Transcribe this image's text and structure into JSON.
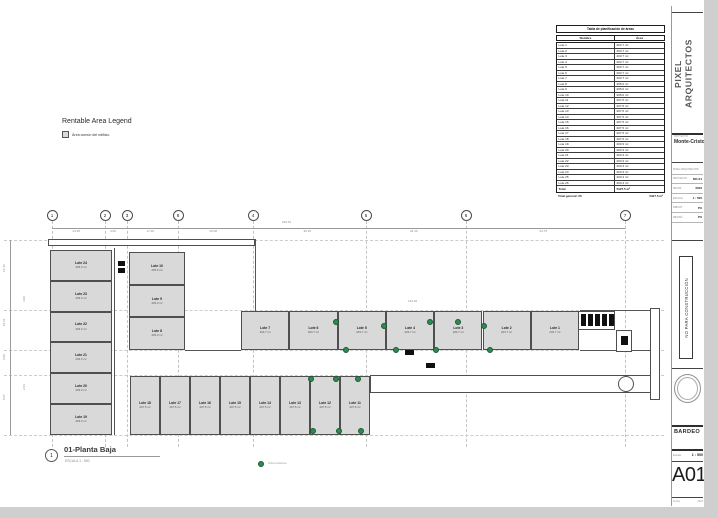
{
  "legend": {
    "title": "Rentable Area Legend",
    "item": "Área común del edificio",
    "swatch_color": "#d9d9d9"
  },
  "schedule": {
    "title": "Tabla de planificación de áreas",
    "columns": [
      "Nombre",
      "Área"
    ],
    "rows": [
      [
        "Lote 1",
        "203.7 m²"
      ],
      [
        "Lote 2",
        "203.7 m²"
      ],
      [
        "Lote 3",
        "203.7 m²"
      ],
      [
        "Lote 4",
        "203.7 m²"
      ],
      [
        "Lote 5",
        "203.7 m²"
      ],
      [
        "Lote 6",
        "203.7 m²"
      ],
      [
        "Lote 7",
        "203.7 m²"
      ],
      [
        "Lote 8",
        "205.0 m²"
      ],
      [
        "Lote 9",
        "205.0 m²"
      ],
      [
        "Lote 10",
        "205.0 m²"
      ],
      [
        "Lote 11",
        "207.5 m²"
      ],
      [
        "Lote 12",
        "207.5 m²"
      ],
      [
        "Lote 13",
        "207.5 m²"
      ],
      [
        "Lote 14",
        "207.5 m²"
      ],
      [
        "Lote 15",
        "207.5 m²"
      ],
      [
        "Lote 16",
        "207.5 m²"
      ],
      [
        "Lote 17",
        "207.5 m²"
      ],
      [
        "Lote 18",
        "207.5 m²"
      ],
      [
        "Lote 19",
        "203.3 m²"
      ],
      [
        "Lote 20",
        "203.3 m²"
      ],
      [
        "Lote 21",
        "203.3 m²"
      ],
      [
        "Lote 22",
        "203.3 m²"
      ],
      [
        "Lote 23",
        "203.3 m²"
      ],
      [
        "Lote 24",
        "203.3 m²"
      ],
      [
        "Lote 25",
        "203.4 m²"
      ],
      [
        "Lote 26",
        "203.4 m²"
      ]
    ],
    "total": [
      "Total",
      "5327.5 m²"
    ],
    "grand_total_label": "Total general: 26",
    "grand_total_value": "5327.5 m²"
  },
  "grid": {
    "bubbles": [
      {
        "label": "1",
        "x": 52
      },
      {
        "label": "2",
        "x": 105
      },
      {
        "label": "3",
        "x": 127
      },
      {
        "label": "8",
        "x": 178
      },
      {
        "label": "4",
        "x": 253
      },
      {
        "label": "5",
        "x": 366
      },
      {
        "label": "6",
        "x": 466
      },
      {
        "label": "7",
        "x": 625
      }
    ],
    "segment_dims": [
      "24.95",
      "4.09",
      "17.06",
      "25.08",
      "36.35",
      "32.40",
      "54.75"
    ],
    "overall_dim": "229.61",
    "mid_dim": "134.62"
  },
  "dims_left": [
    {
      "t": "16.46",
      "x": 3,
      "y": 272
    },
    {
      "t": "10.61",
      "x": 3,
      "y": 326
    },
    {
      "t": "6.00",
      "x": 3,
      "y": 360
    },
    {
      "t": "8.67",
      "x": 3,
      "y": 400
    },
    {
      "t": "4.00",
      "x": 23,
      "y": 302
    },
    {
      "t": "2.04",
      "x": 23,
      "y": 390
    }
  ],
  "plan": {
    "left_column": [
      [
        "Lote 24",
        "203.3 m²"
      ],
      [
        "Lote 23",
        "203.3 m²"
      ],
      [
        "Lote 22",
        "203.3 m²"
      ],
      [
        "Lote 21",
        "203.3 m²"
      ],
      [
        "Lote 20",
        "203.3 m²"
      ],
      [
        "Lote 19",
        "203.3 m²"
      ]
    ],
    "mid_column": [
      [
        "Lote 10",
        "205.0 m²"
      ],
      [
        "Lote 9",
        "205.0 m²"
      ],
      [
        "Lote 8",
        "205.0 m²"
      ]
    ],
    "middle_row": [
      [
        "Lote 7",
        "203.7 m²"
      ],
      [
        "Lote 6",
        "203.7 m²"
      ],
      [
        "Lote 5",
        "203.7 m²"
      ],
      [
        "Lote 4",
        "203.7 m²"
      ],
      [
        "Lote 3",
        "203.7 m²"
      ],
      [
        "Lote 2",
        "203.7 m²"
      ],
      [
        "Lote 1",
        "203.7 m²"
      ]
    ],
    "bottom_row": [
      [
        "Lote 18",
        "207.5 m²"
      ],
      [
        "Lote 17",
        "207.5 m²"
      ],
      [
        "Lote 16",
        "207.5 m²"
      ],
      [
        "Lote 15",
        "207.5 m²"
      ],
      [
        "Lote 14",
        "207.5 m²"
      ],
      [
        "Lote 13",
        "207.5 m²"
      ],
      [
        "Lote 12",
        "207.5 m²"
      ],
      [
        "Lote 11",
        "207.5 m²"
      ]
    ],
    "trees": [
      [
        336,
        322
      ],
      [
        384,
        326
      ],
      [
        430,
        322
      ],
      [
        458,
        322
      ],
      [
        484,
        326
      ],
      [
        346,
        350
      ],
      [
        396,
        350
      ],
      [
        436,
        350
      ],
      [
        490,
        350
      ],
      [
        311,
        379
      ],
      [
        336,
        379
      ],
      [
        358,
        379
      ],
      [
        313,
        431
      ],
      [
        339,
        431
      ],
      [
        361,
        431
      ],
      [
        261,
        464
      ]
    ]
  },
  "view_title": {
    "bubble": "1",
    "title": "01-Planta Baja",
    "scale": "ESCALA   1 : 500",
    "tree_note": "Árbol existente"
  },
  "titleblock": {
    "firm": "PIXEL\nARQUITECTOS",
    "project_label": "PROYECTO",
    "project": "Monte-Cristo",
    "info_rows": [
      [
        "PIXEL ARQUITECTOS",
        ""
      ],
      [
        "PROYECTO",
        "MC-01"
      ],
      [
        "FECHA",
        "2023"
      ],
      [
        "ESCALA",
        "1 : 500"
      ],
      [
        "DIBUJÓ",
        "PX"
      ],
      [
        "REVISÓ",
        "PX"
      ]
    ],
    "status": "NO PARA CONSTRUCCIÓN",
    "zone": "BARDEO",
    "scale_label": "Escala",
    "scale_value": "1 : 500",
    "sheet_number": "A01",
    "footer_left": "Fecha",
    "footer_right": "2023"
  }
}
